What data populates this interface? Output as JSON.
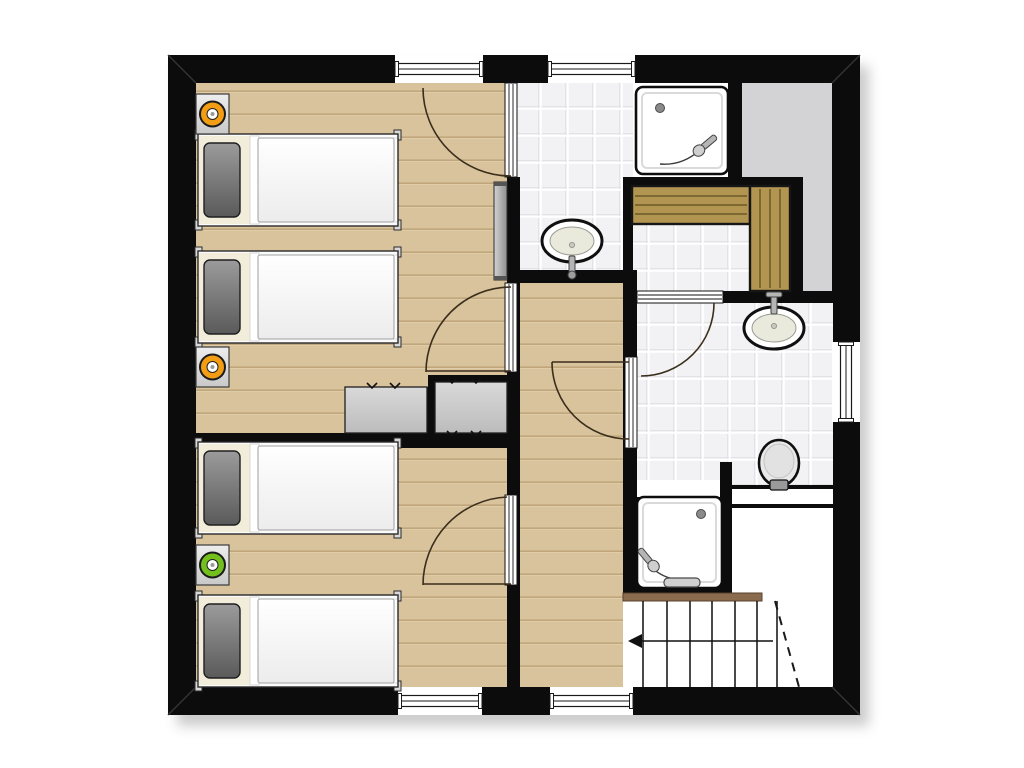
{
  "title": "upper-floor-plan",
  "canvas": {
    "w": 1024,
    "h": 768,
    "bg": "#ffffff"
  },
  "palette": {
    "wall": "#0c0c0c",
    "wood": "#d8c39c",
    "woodLine": "#c0a67a",
    "woodLight": "#e4d4b2",
    "tile": "#f2f2f4",
    "tileLine": "#ffffff",
    "tileShade": "#e3e3e7",
    "grayFloor": "#d3d3d5",
    "bench": "#b29551",
    "benchLine": "#7e6832",
    "stairRail": "#8a6b4e",
    "stairRailEdge": "#55402b",
    "swing": "#3c2e1c",
    "orange": "#f29d14",
    "green": "#72bf1d",
    "fixtureStroke": "#101010",
    "basin": "#e9e9dc",
    "metal": "#b5b5b5",
    "metalDark": "#424242",
    "cabinet1": "#d9d9d9",
    "cabinet2": "#bcbcbc",
    "panel1": "#d2d2d2",
    "panel2": "#8f8f8f",
    "pillow1": "#9b9b9b",
    "pillow2": "#5a5a5a",
    "duvet1": "#ffffff",
    "duvet2": "#ececec",
    "headboard": "#f2eddb",
    "bedFrame": "#fbfbfb",
    "shadow": "#8e8e8e"
  },
  "building": {
    "x": 168,
    "y": 55,
    "w": 692,
    "h": 660,
    "t": 28
  },
  "floors": [
    {
      "name": "bedroom-1-floor",
      "kind": "wood",
      "x": 196,
      "y": 83,
      "w": 311,
      "h": 362
    },
    {
      "name": "bedroom-2-floor",
      "kind": "wood",
      "x": 196,
      "y": 448,
      "w": 311,
      "h": 239
    },
    {
      "name": "corridor-floor",
      "kind": "wood",
      "x": 520,
      "y": 283,
      "w": 103,
      "h": 404
    },
    {
      "name": "bathroom-1-floor",
      "kind": "tile",
      "x": 517,
      "y": 83,
      "w": 116,
      "h": 187
    },
    {
      "name": "shower-1-niche",
      "kind": "plain",
      "x": 633,
      "y": 83,
      "w": 95,
      "h": 94
    },
    {
      "name": "sauna-floor",
      "kind": "tile",
      "x": 632,
      "y": 186,
      "w": 158,
      "h": 105
    },
    {
      "name": "storage-void-top",
      "kind": "gray",
      "x": 742,
      "y": 83,
      "w": 90,
      "h": 94
    },
    {
      "name": "storage-void-side",
      "kind": "gray",
      "x": 803,
      "y": 177,
      "w": 29,
      "h": 116
    },
    {
      "name": "bathroom-2-floor",
      "kind": "tile",
      "x": 637,
      "y": 303,
      "w": 196,
      "h": 194
    },
    {
      "name": "shower-2-niche",
      "kind": "plain",
      "x": 637,
      "y": 480,
      "w": 85,
      "h": 17
    },
    {
      "name": "stair-void",
      "kind": "plain",
      "x": 732,
      "y": 508,
      "w": 101,
      "h": 85
    },
    {
      "name": "stair-area",
      "kind": "plain",
      "x": 623,
      "y": 593,
      "w": 210,
      "h": 94
    }
  ],
  "walls": [
    {
      "name": "wall-bed1-bath1",
      "x": 507,
      "y": 177,
      "w": 13,
      "h": 108
    },
    {
      "name": "wall-bed1-corridor",
      "x": 507,
      "y": 372,
      "w": 13,
      "h": 123
    },
    {
      "name": "wall-bed2-corridor",
      "x": 507,
      "y": 585,
      "w": 13,
      "h": 102
    },
    {
      "name": "wall-bath1-south",
      "x": 507,
      "y": 270,
      "w": 130,
      "h": 13
    },
    {
      "name": "wall-corridor-bath2-n",
      "x": 623,
      "y": 283,
      "w": 14,
      "h": 74
    },
    {
      "name": "wall-corridor-bath2-s",
      "x": 623,
      "y": 448,
      "w": 14,
      "h": 145
    },
    {
      "name": "wall-between-bedrooms",
      "x": 196,
      "y": 433,
      "w": 311,
      "h": 15
    },
    {
      "name": "wall-wardrobe-top",
      "x": 428,
      "y": 375,
      "w": 79,
      "h": 12
    },
    {
      "name": "wall-wardrobe-mid",
      "x": 427,
      "y": 387,
      "w": 8,
      "h": 46
    },
    {
      "name": "wall-shower1-east",
      "x": 728,
      "y": 55,
      "w": 14,
      "h": 122
    },
    {
      "name": "wall-sauna-north",
      "x": 623,
      "y": 177,
      "w": 180,
      "h": 11
    },
    {
      "name": "wall-sauna-west",
      "x": 623,
      "y": 188,
      "w": 10,
      "h": 103
    },
    {
      "name": "wall-sauna-east",
      "x": 790,
      "y": 188,
      "w": 13,
      "h": 115
    },
    {
      "name": "wall-sauna-south-w",
      "x": 623,
      "y": 291,
      "w": 14,
      "h": 12
    },
    {
      "name": "wall-sauna-south-e",
      "x": 723,
      "y": 291,
      "w": 110,
      "h": 12
    },
    {
      "name": "wall-toilet-stub",
      "x": 720,
      "y": 462,
      "w": 12,
      "h": 131
    }
  ],
  "miters": [
    [
      168,
      55,
      196,
      83
    ],
    [
      860,
      55,
      832,
      83
    ],
    [
      168,
      715,
      196,
      687
    ],
    [
      860,
      715,
      832,
      687
    ]
  ],
  "windows": [
    {
      "name": "window-north-1",
      "x": 395,
      "y": 55,
      "w": 88,
      "h": 28,
      "o": "h"
    },
    {
      "name": "window-north-2",
      "x": 548,
      "y": 55,
      "w": 87,
      "h": 28,
      "o": "h"
    },
    {
      "name": "window-south-1",
      "x": 398,
      "y": 687,
      "w": 84,
      "h": 28,
      "o": "h"
    },
    {
      "name": "window-south-2",
      "x": 550,
      "y": 687,
      "w": 83,
      "h": 28,
      "o": "h"
    },
    {
      "name": "window-east-1",
      "x": 832,
      "y": 342,
      "w": 28,
      "h": 80,
      "o": "v"
    }
  ],
  "door_frames": [
    {
      "name": "door-bed1-bath1",
      "x": 505,
      "y": 83,
      "w": 12,
      "h": 94,
      "o": "v"
    },
    {
      "name": "door-bed1-corridor",
      "x": 505,
      "y": 283,
      "w": 12,
      "h": 89,
      "o": "v"
    },
    {
      "name": "door-bed2-corridor",
      "x": 505,
      "y": 495,
      "w": 12,
      "h": 90,
      "o": "v"
    },
    {
      "name": "door-corridor-bath2",
      "x": 625,
      "y": 357,
      "w": 12,
      "h": 91,
      "o": "v"
    },
    {
      "name": "door-bath2-sauna",
      "x": 637,
      "y": 291,
      "w": 86,
      "h": 12,
      "o": "h"
    }
  ],
  "door_swings": [
    {
      "name": "swing-bed1-bath1",
      "d": "M 423 88 A 88 88 0 0 0 511 176"
    },
    {
      "name": "swing-bed1-corridor",
      "d": "M 511 287 A 85 85 0 0 0 426 372"
    },
    {
      "name": "leaf-bed1-corridor",
      "d": "M 426 371 L 511 371"
    },
    {
      "name": "swing-bed2-corridor",
      "d": "M 507 497 A 88 88 0 0 0 423 585"
    },
    {
      "name": "leaf-bed2-corridor",
      "d": "M 423 584 L 511 584"
    },
    {
      "name": "swing-corridor-bath2",
      "d": "M 552 362 A 77 77 0 0 0 629 439"
    },
    {
      "name": "leaf-corridor-bath2",
      "d": "M 552 362 L 629 362"
    },
    {
      "name": "swing-bath2-sauna",
      "d": "M 714 303 A 73 73 0 0 1 641 376"
    }
  ],
  "panel": {
    "name": "sliding-door-panel",
    "x": 494,
    "y": 182,
    "w": 13,
    "h": 98
  },
  "wardrobes": [
    {
      "name": "wardrobe-1",
      "x": 345,
      "y": 387,
      "w": 82,
      "h": 46,
      "ticks": [
        [
          372,
          386
        ],
        [
          395,
          386
        ]
      ]
    },
    {
      "name": "wardrobe-2",
      "x": 435,
      "y": 382,
      "w": 72,
      "h": 51,
      "ticks": [
        [
          452,
          381
        ],
        [
          476,
          381
        ],
        [
          452,
          434
        ],
        [
          476,
          434
        ]
      ]
    }
  ],
  "sauna_benches": [
    {
      "name": "sauna-bench-top",
      "x": 632,
      "y": 186,
      "w": 118,
      "h": 38,
      "o": "h"
    },
    {
      "name": "sauna-bench-right",
      "x": 750,
      "y": 186,
      "w": 40,
      "h": 105,
      "o": "v"
    }
  ],
  "showers": [
    {
      "name": "shower-tray-1",
      "x": 636,
      "y": 87,
      "w": 92,
      "h": 87,
      "drain": [
        24,
        21
      ],
      "head": {
        "x": 66,
        "y": 61,
        "rot": -130
      },
      "hose": "M 700 150 q -18 16 -40 14"
    },
    {
      "name": "shower-tray-2",
      "x": 637,
      "y": 497,
      "w": 85,
      "h": 91,
      "drain": [
        64,
        17
      ],
      "head": {
        "x": 14,
        "y": 66,
        "rot": 140
      },
      "hose": "M 652 568 q 16 14 38 12",
      "rail": [
        664,
        578,
        36,
        9
      ]
    }
  ],
  "sinks": [
    {
      "name": "washbasin-1",
      "cx": 572,
      "cy": 241,
      "rx": 30,
      "ry": 21,
      "tap": "down"
    },
    {
      "name": "washbasin-2",
      "cx": 774,
      "cy": 328,
      "rx": 30,
      "ry": 21,
      "tap": "up"
    }
  ],
  "toilet": {
    "name": "toilet",
    "cx": 779,
    "cy": 463,
    "rx": 20,
    "ry": 23
  },
  "ledge": {
    "name": "half-wall-ledge",
    "x": 732,
    "y": 485,
    "w": 101,
    "h": 23
  },
  "stairs": {
    "name": "staircase",
    "rail": [
      623,
      593,
      139,
      8
    ],
    "treads_x": [
      643,
      667,
      690,
      712,
      735,
      757,
      777
    ],
    "tread_y": [
      601,
      687
    ],
    "arrow": {
      "y": 641,
      "x1": 633,
      "x2": 773
    },
    "dashed": "M 775 601 L 799 687"
  },
  "beds": [
    {
      "name": "bed-1",
      "x": 198,
      "y": 134
    },
    {
      "name": "bed-2",
      "x": 198,
      "y": 251
    },
    {
      "name": "bed-3",
      "x": 198,
      "y": 442
    },
    {
      "name": "bed-4",
      "x": 198,
      "y": 595
    }
  ],
  "bed_size": {
    "w": 200,
    "h": 92
  },
  "nightstands": [
    {
      "name": "nightstand-1",
      "x": 196,
      "y": 94,
      "ring": "orange"
    },
    {
      "name": "nightstand-2",
      "x": 196,
      "y": 347,
      "ring": "orange"
    },
    {
      "name": "nightstand-3",
      "x": 196,
      "y": 545,
      "ring": "green"
    }
  ]
}
